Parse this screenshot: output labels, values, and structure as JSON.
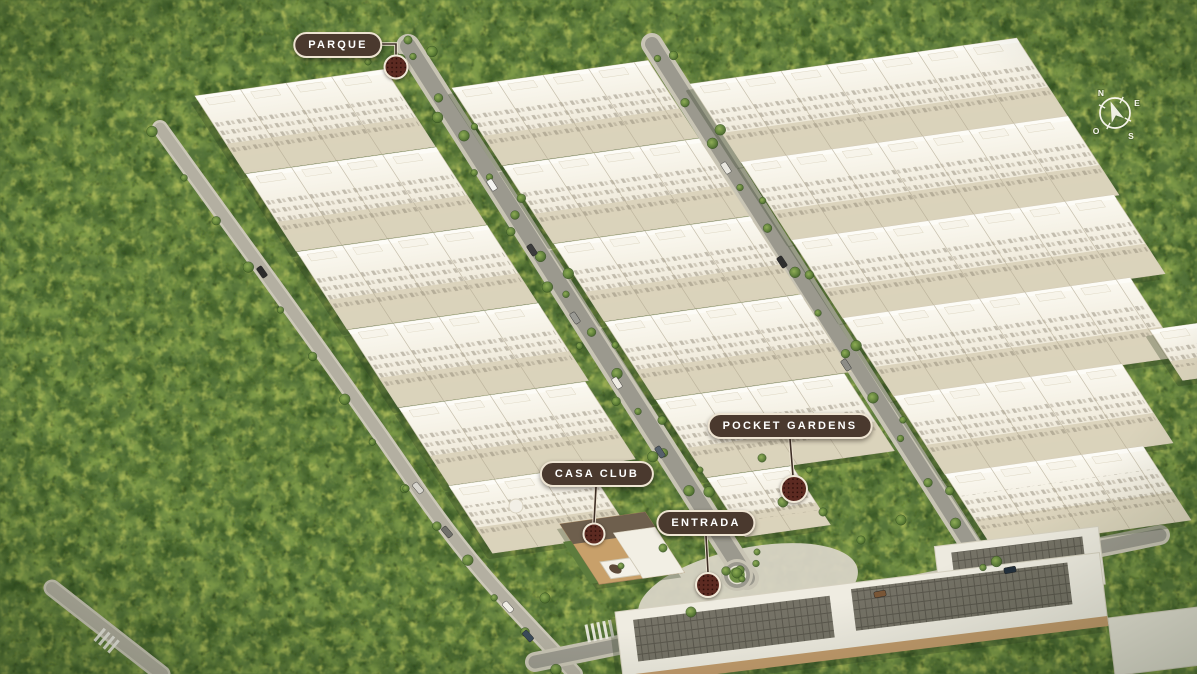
{
  "labels": {
    "parque": {
      "text": "PARQUE"
    },
    "pocket_gardens": {
      "text": "POCKET GARDENS"
    },
    "casa_club": {
      "text": "CASA CLUB"
    },
    "entrada": {
      "text": "ENTRADA"
    }
  },
  "compass": {
    "north": "N",
    "east": "E",
    "south": "S",
    "west": "O"
  },
  "icons": {
    "marker": "dotted-location-marker",
    "compass_needle": "north-arrow"
  },
  "colors": {
    "label_background": "#4a392e",
    "label_border": "#eee4d2",
    "label_text": "#ffffff",
    "marker": "#5c2a21",
    "forest_base": "#55743a",
    "forest_highlight": "#a8b757",
    "building_facade": "#f3efe2",
    "road": "#9b998e",
    "solar_roof": "#757266",
    "roundabout_green": "#6f8f45"
  }
}
